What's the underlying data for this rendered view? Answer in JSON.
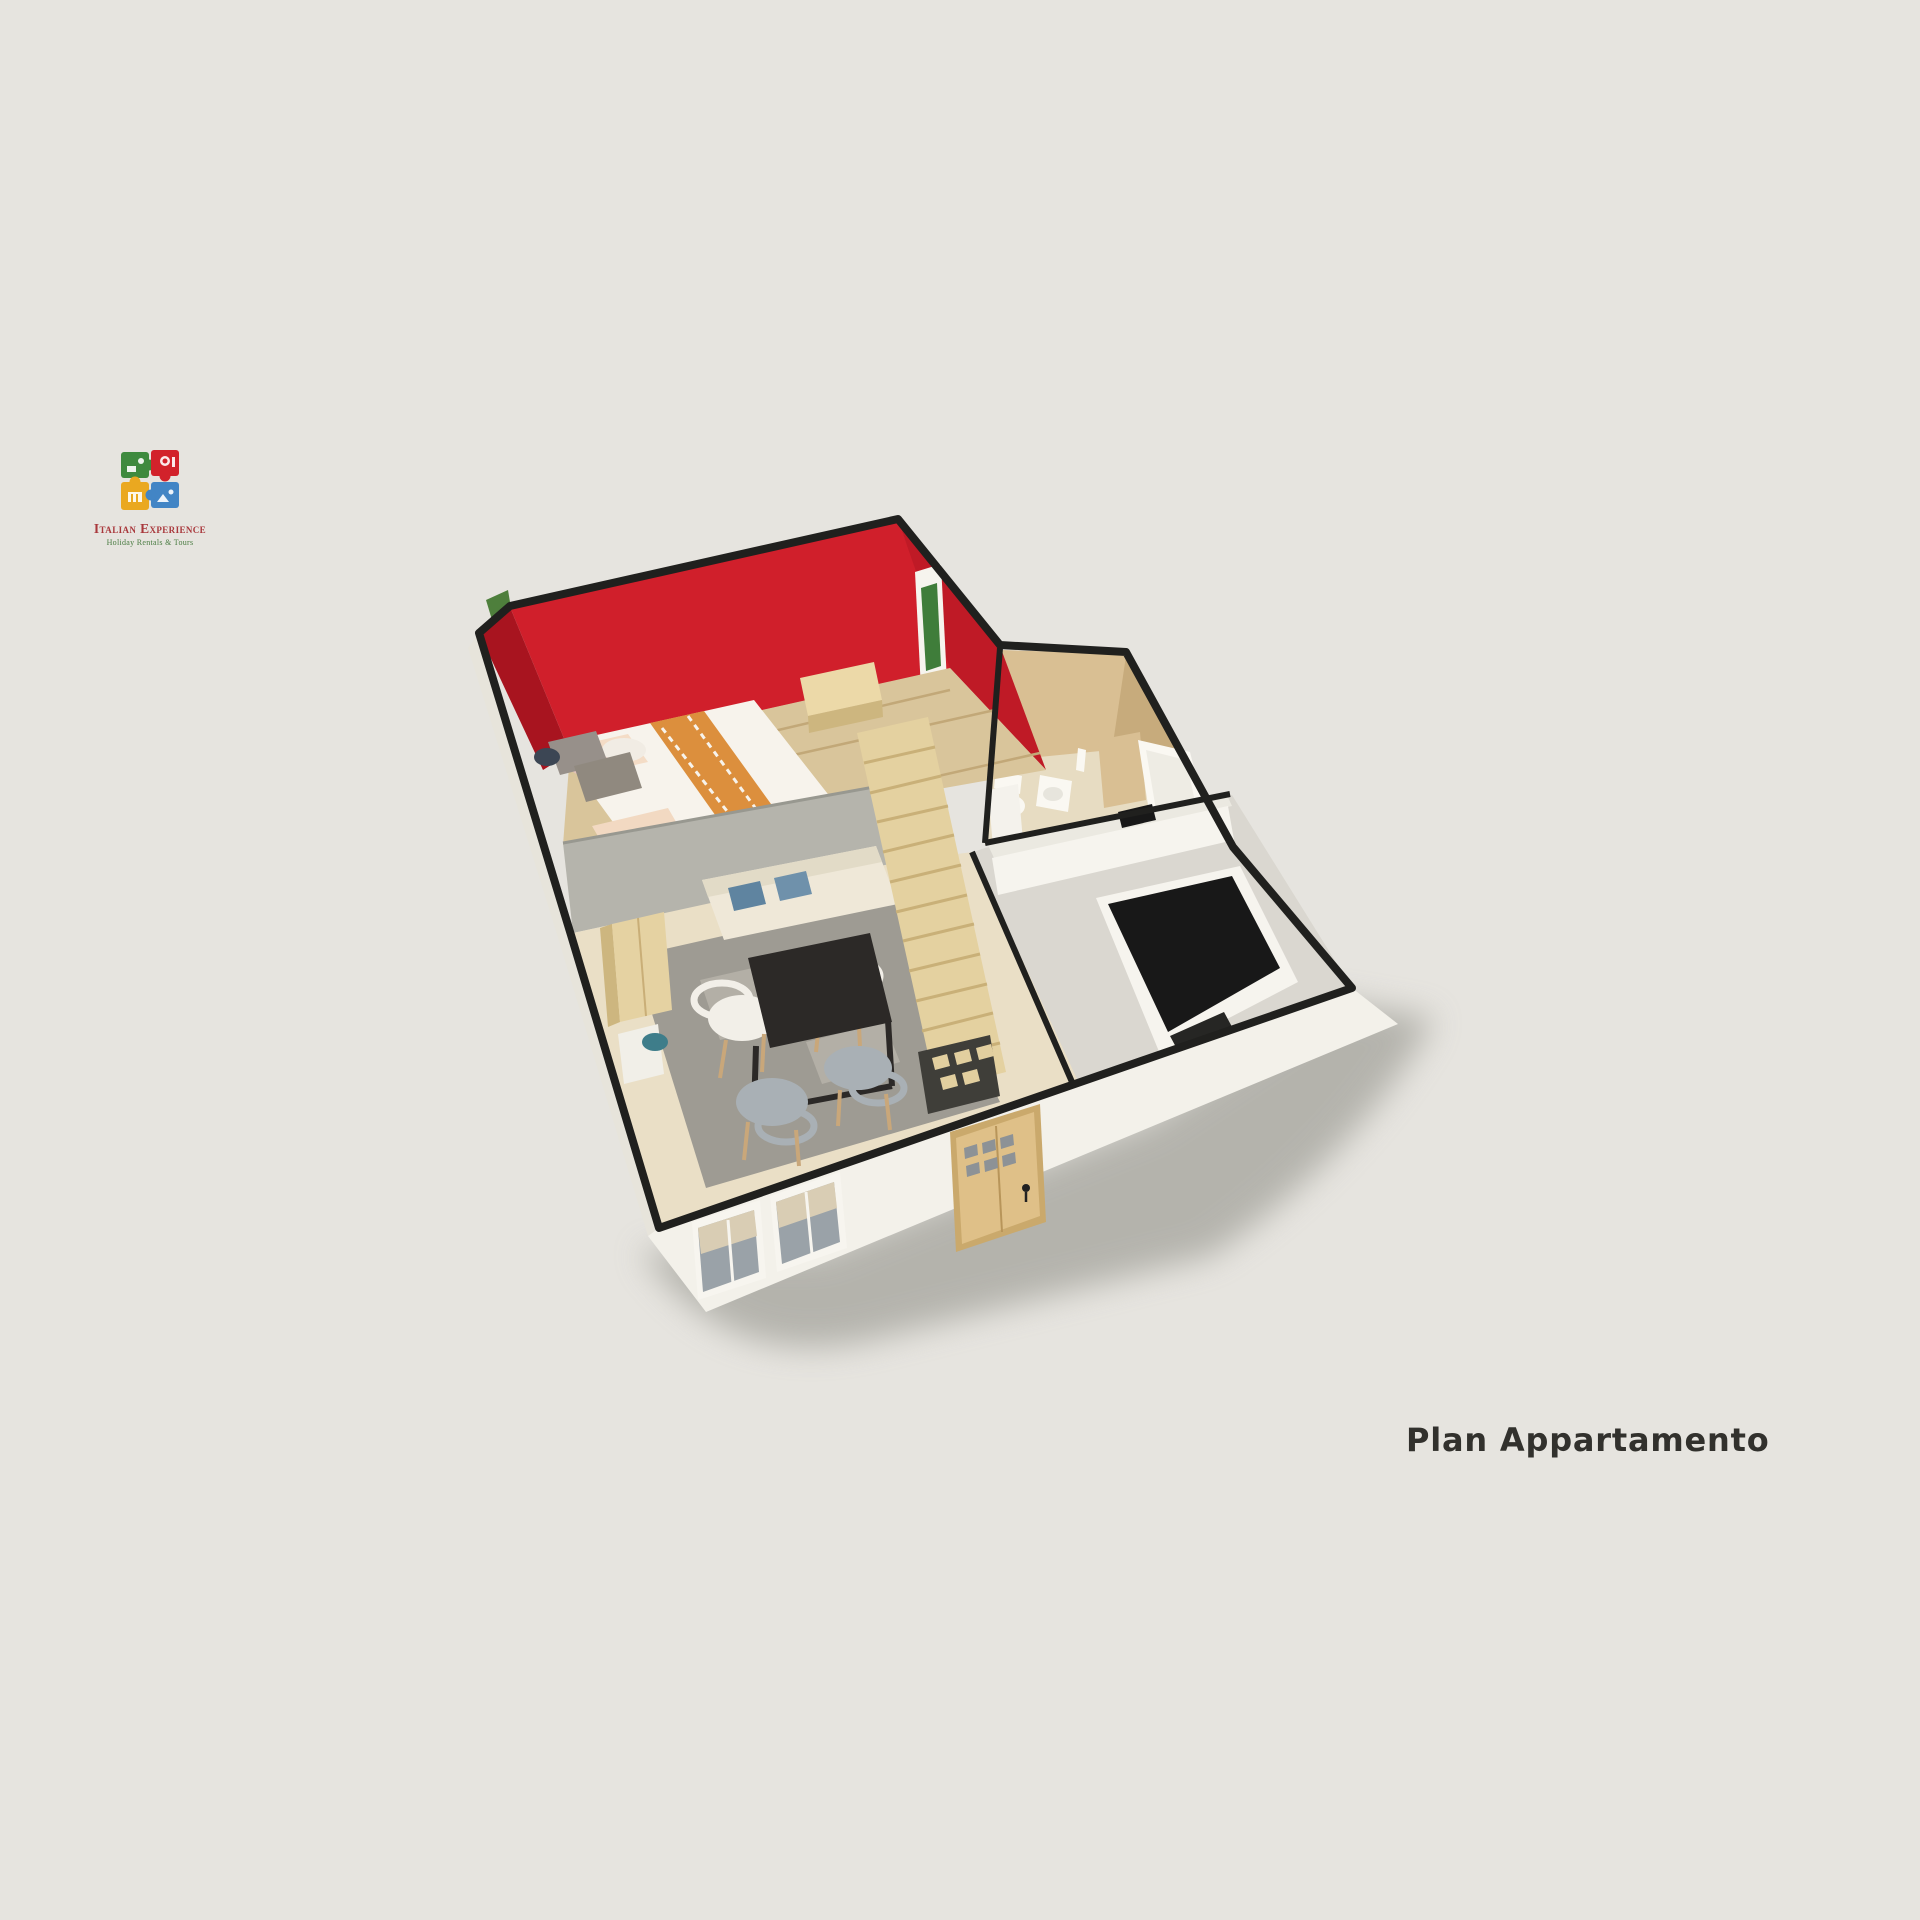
{
  "page": {
    "caption": "Plan Appartamento"
  },
  "logo": {
    "brand": "Italian Experience",
    "tagline": "Holiday Rentals & Tours",
    "pieces": [
      "green-puzzle-piece",
      "red-puzzle-piece",
      "yellow-puzzle-piece",
      "blue-puzzle-piece"
    ]
  },
  "floorplan": {
    "rooms": [
      "bedroom-loft",
      "bathroom",
      "kitchen",
      "living-dining-room",
      "staircase"
    ]
  },
  "colors": {
    "bg": "#e6e4df",
    "caption_text": "#32312d",
    "brand_text": "#a9383c",
    "tagline_text": "#4a7c42",
    "puzzle_green": "#3e8a3e",
    "puzzle_red": "#d2222b",
    "puzzle_yellow": "#eaa820",
    "puzzle_blue": "#4285c5",
    "outline": "#20201e",
    "shadow": "#8c8c84",
    "wall_red_bright": "#d01f2b",
    "wall_red_dark": "#a8141f",
    "wall_red_side": "#bf1a26",
    "frame_green": "#3f7d3a",
    "plant_green": "#4e7f3c",
    "loft_floor": "#d9c59b",
    "loft_line": "#c2a878",
    "bed_white": "#f7f3ec",
    "bed_orange": "#dc8f3d",
    "pillow_pink": "#e3c3bb",
    "headboard_gray": "#97908a",
    "parapet_gray": "#b5b4ac",
    "stairs_wood": "#e4d1a0",
    "stairs_line": "#c9b078",
    "living_floor": "#eadfc6",
    "rug": "#9e9b93",
    "rug_light": "#b3afa6",
    "table_dark": "#2c2927",
    "chair_white": "#f2efe8",
    "chair_gray": "#a9b0b5",
    "leg_wood": "#c9a77a",
    "sofa": "#efe8d8",
    "pillow_blue": "#5f84a0",
    "wardrobe_wood": "#e5d2a2",
    "door_wood": "#dfc088",
    "window_glass": "#9aa2a8",
    "window_blind": "#d9cdb4",
    "kitchen_floor": "#dad7d0",
    "counter_white": "#f6f4ee",
    "counter_black": "#181818",
    "bath_wall": "#d9bf93",
    "bath_wall_dark": "#c7ab7c",
    "bath_floor": "#e7dcc2",
    "fixture_white": "#faf8f2",
    "exterior_white": "#f3f1ea",
    "exterior_shade": "#e7e4db",
    "teal_item": "#3e7d8a"
  }
}
